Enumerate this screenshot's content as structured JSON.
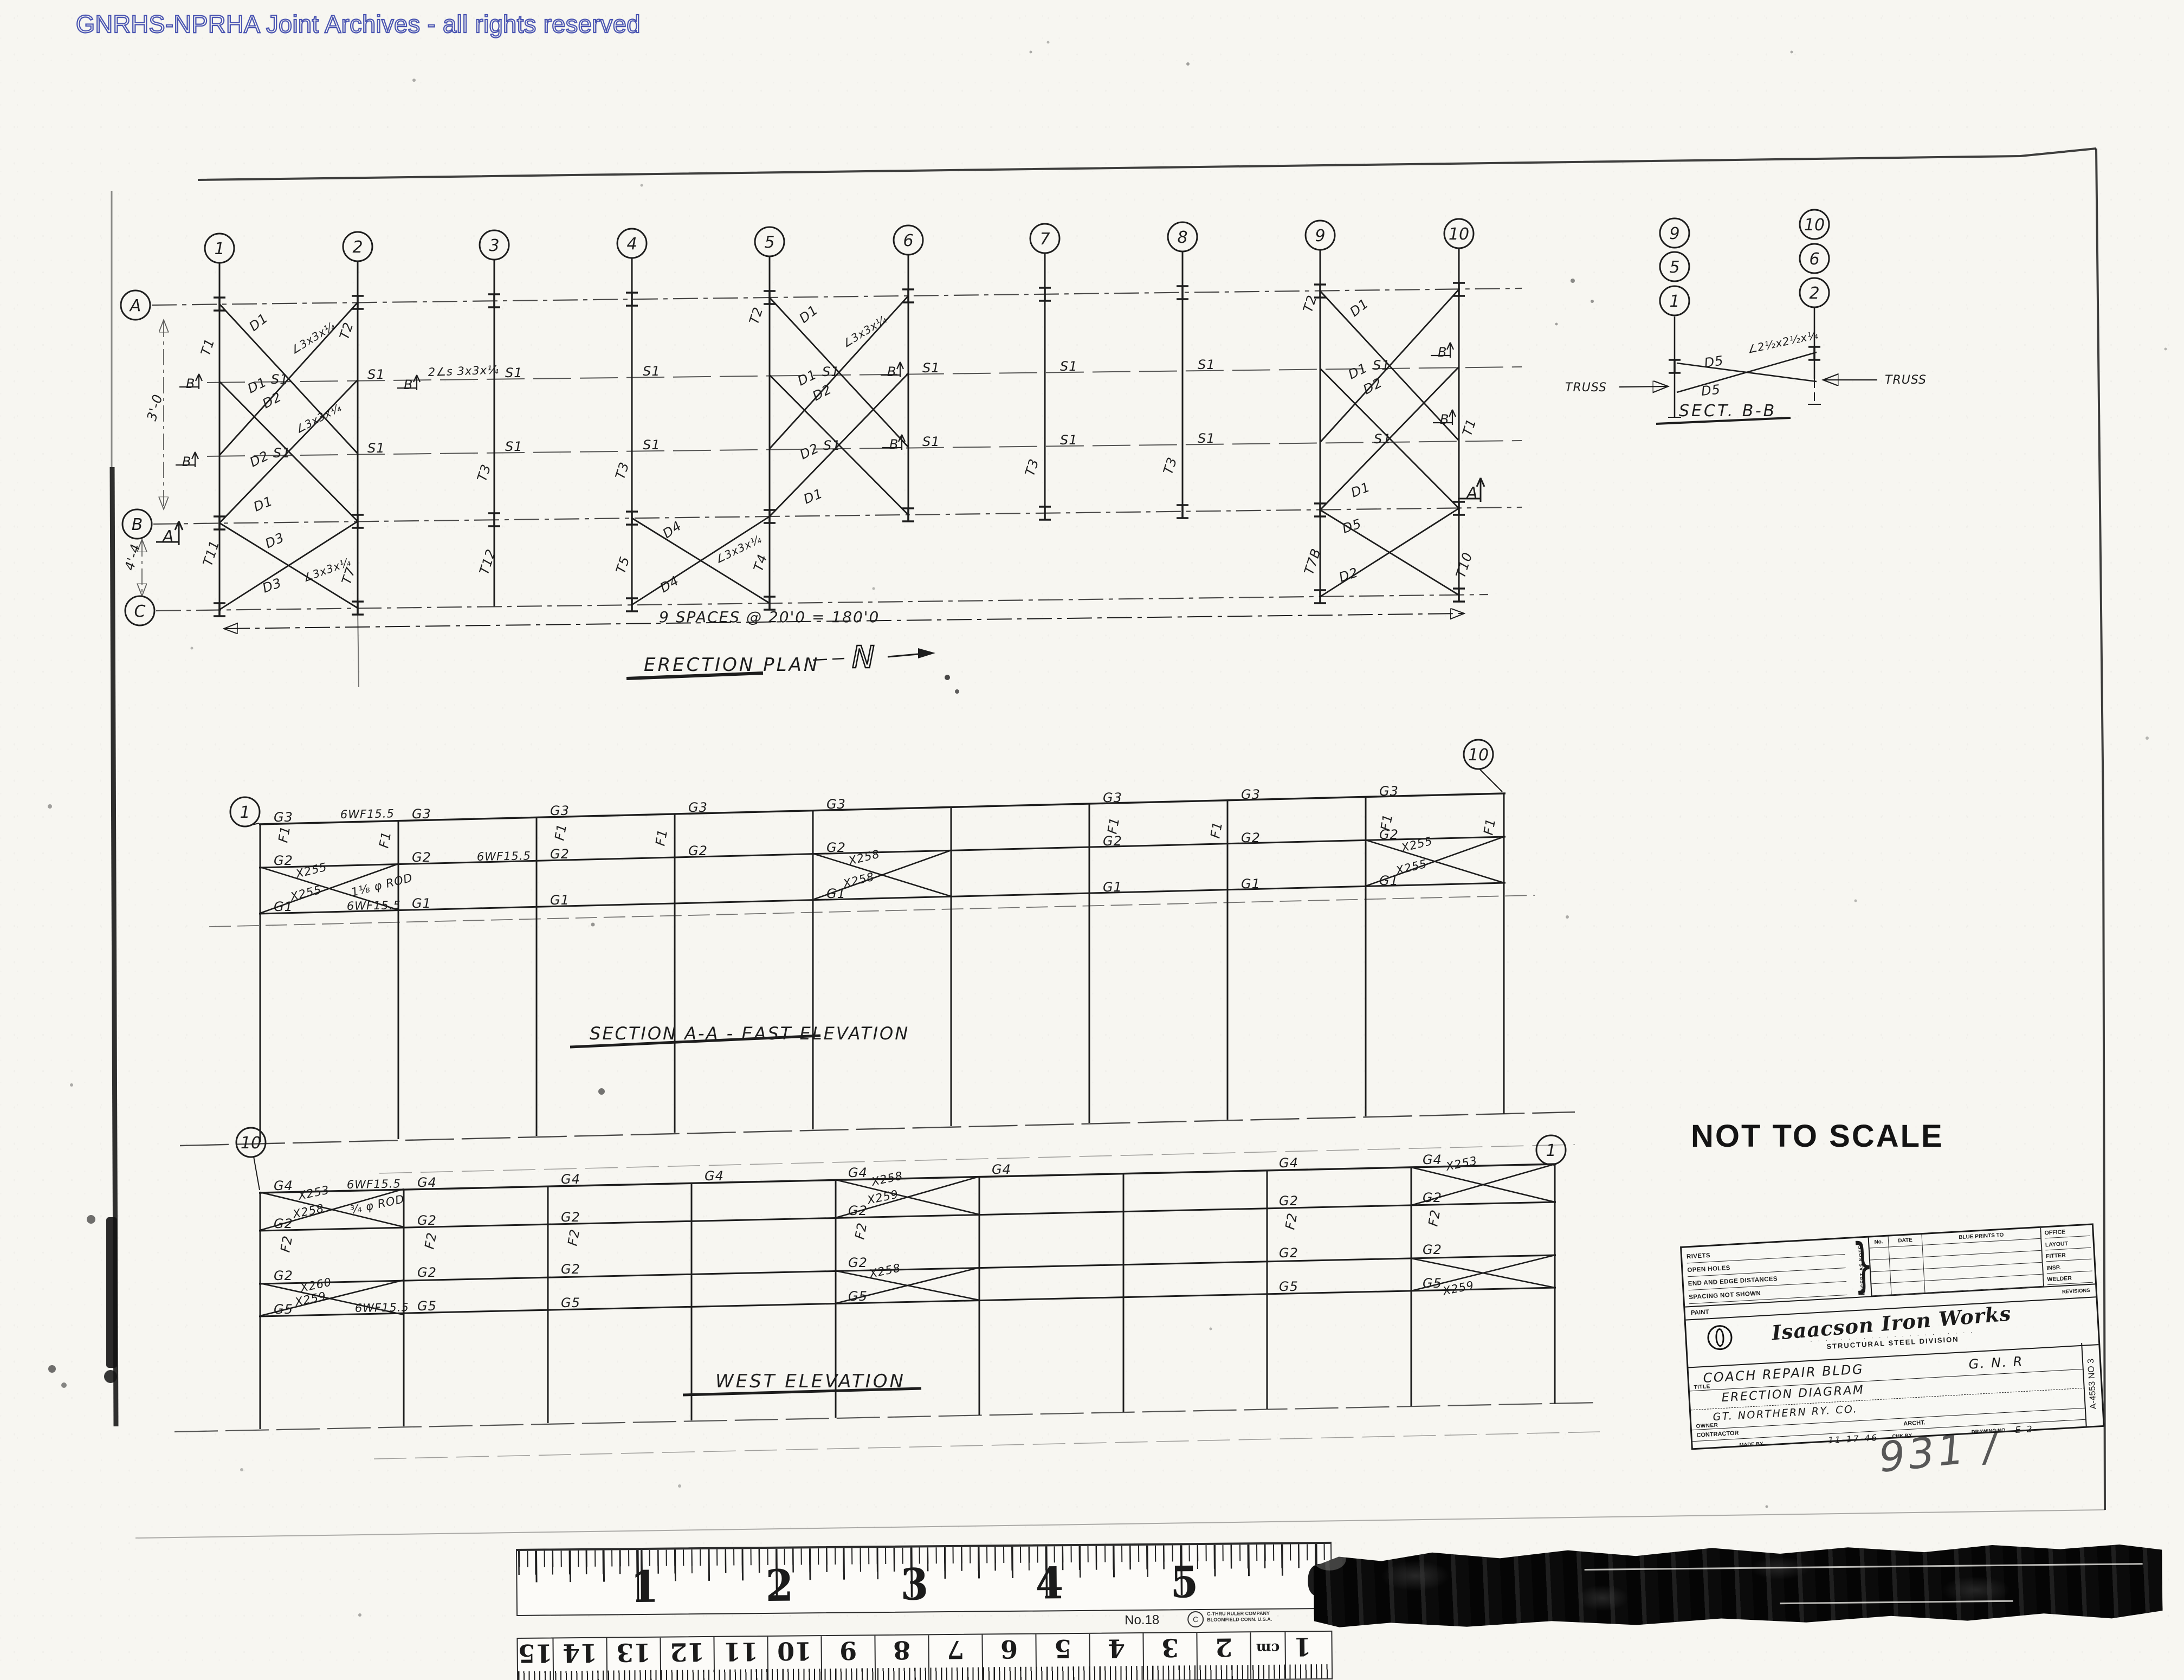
{
  "watermark": "GNRHS-NPRHA Joint Archives - all rights reserved",
  "titles": {
    "erection_plan": "ERECTION PLAN",
    "north": "N",
    "spaces_note": "9 SPACES @ 20'0 = 180'0",
    "section_aa": "SECTION A-A  -  EAST ELEVATION",
    "west_elevation": "WEST  ELEVATION",
    "sect_bb": "SECT. B-B",
    "not_to_scale": "NOT TO SCALE",
    "handwritten_note": "931 /"
  },
  "bubbles": [
    [
      "1",
      405,
      458
    ],
    [
      "2",
      660,
      455
    ],
    [
      "3",
      912,
      452
    ],
    [
      "4",
      1166,
      449
    ],
    [
      "5",
      1420,
      446
    ],
    [
      "6",
      1676,
      443
    ],
    [
      "7",
      1928,
      440
    ],
    [
      "8",
      2182,
      437
    ],
    [
      "9",
      2436,
      434
    ],
    [
      "10",
      2692,
      431
    ],
    [
      "A",
      250,
      563
    ],
    [
      "B",
      253,
      967
    ],
    [
      "C",
      258,
      1127
    ],
    [
      "1",
      452,
      1498
    ],
    [
      "10",
      2728,
      1392
    ],
    [
      "10",
      463,
      2108
    ],
    [
      "1",
      2862,
      2122
    ],
    [
      "9",
      3090,
      430
    ],
    [
      "5",
      3090,
      492
    ],
    [
      "1",
      3090,
      555
    ],
    [
      "10",
      3348,
      414
    ],
    [
      "6",
      3348,
      477
    ],
    [
      "2",
      3348,
      540
    ]
  ],
  "plan": {
    "ibeams": [
      [
        405,
        561
      ],
      [
        660,
        558
      ],
      [
        912,
        555
      ],
      [
        1166,
        552
      ],
      [
        1420,
        549
      ],
      [
        1676,
        546
      ],
      [
        1928,
        543
      ],
      [
        2182,
        540
      ],
      [
        2436,
        537
      ],
      [
        2692,
        534
      ],
      [
        405,
        965
      ],
      [
        660,
        962
      ],
      [
        912,
        959
      ],
      [
        1166,
        956
      ],
      [
        1420,
        953
      ],
      [
        1676,
        950
      ],
      [
        1928,
        947
      ],
      [
        2182,
        944
      ],
      [
        2436,
        941
      ],
      [
        2692,
        938
      ],
      [
        405,
        1125
      ],
      [
        660,
        1122
      ],
      [
        1166,
        1116
      ],
      [
        1420,
        1113
      ],
      [
        2436,
        1101
      ],
      [
        2692,
        1098
      ],
      [
        3090,
        676
      ],
      [
        3348,
        652
      ]
    ]
  },
  "labels": [
    [
      "T1",
      386,
      658,
      -72
    ],
    [
      "T2",
      642,
      628,
      -72
    ],
    [
      "T3",
      896,
      890,
      -72
    ],
    [
      "T3",
      1151,
      886,
      -72
    ],
    [
      "T2",
      1398,
      600,
      -72
    ],
    [
      "T3",
      1907,
      880,
      -72
    ],
    [
      "T3",
      2162,
      877,
      -72
    ],
    [
      "T2",
      2420,
      578,
      -72
    ],
    [
      "T1",
      2714,
      806,
      -72
    ],
    [
      "T11",
      390,
      1046,
      -72
    ],
    [
      "T7",
      646,
      1080,
      -72
    ],
    [
      "T12",
      900,
      1062,
      -72
    ],
    [
      "T5",
      1152,
      1060,
      -72
    ],
    [
      "T4",
      1406,
      1056,
      -72
    ],
    [
      "T7B",
      2422,
      1062,
      -72
    ],
    [
      "T10",
      2702,
      1068,
      -72
    ],
    [
      "D1",
      468,
      612,
      -38
    ],
    [
      "∠3x3x¼",
      542,
      654,
      -32,
      20
    ],
    [
      "D1",
      462,
      726,
      -26
    ],
    [
      "S1",
      500,
      708,
      0
    ],
    [
      "D2",
      490,
      754,
      -28
    ],
    [
      "∠3x3x¼",
      550,
      800,
      -28,
      20
    ],
    [
      "D2",
      466,
      862,
      -26
    ],
    [
      "S1",
      504,
      844,
      0
    ],
    [
      "D1",
      472,
      944,
      -22
    ],
    [
      "D1",
      1483,
      597,
      -38
    ],
    [
      "D1",
      1477,
      712,
      -26
    ],
    [
      "S1",
      1517,
      694,
      0
    ],
    [
      "D2",
      1505,
      740,
      -28
    ],
    [
      "D2",
      1481,
      848,
      -26
    ],
    [
      "S1",
      1519,
      830,
      0
    ],
    [
      "D1",
      1487,
      930,
      -22
    ],
    [
      "∠3x3x¼",
      1560,
      642,
      -32,
      20
    ],
    [
      "D1",
      2499,
      585,
      -38
    ],
    [
      "D1",
      2493,
      700,
      -26
    ],
    [
      "S1",
      2533,
      682,
      0
    ],
    [
      "D2",
      2521,
      728,
      -28
    ],
    [
      "S1",
      2535,
      818,
      0
    ],
    [
      "D1",
      2497,
      918,
      -22
    ],
    [
      "D3",
      494,
      1012,
      -24
    ],
    [
      "D3",
      488,
      1094,
      -20
    ],
    [
      "∠3x3x¼",
      562,
      1074,
      -20,
      20
    ],
    [
      "D4",
      1230,
      994,
      -34
    ],
    [
      "D4",
      1224,
      1094,
      -30
    ],
    [
      "∠3x3x¼",
      1324,
      1040,
      -26,
      20
    ],
    [
      "D5",
      2480,
      984,
      -18
    ],
    [
      "D2",
      2474,
      1074,
      -18
    ],
    [
      "S1",
      678,
      699
    ],
    [
      "S1",
      932,
      696
    ],
    [
      "S1",
      1186,
      693
    ],
    [
      "S1",
      1702,
      687
    ],
    [
      "S1",
      1956,
      684
    ],
    [
      "S1",
      2210,
      681
    ],
    [
      "S1",
      678,
      835
    ],
    [
      "S1",
      932,
      832
    ],
    [
      "S1",
      1186,
      829
    ],
    [
      "S1",
      1702,
      823
    ],
    [
      "S1",
      1956,
      820
    ],
    [
      "S1",
      2210,
      817
    ],
    [
      "2∠s 3x3x¼",
      790,
      694,
      -2,
      21
    ],
    [
      "B",
      343,
      716
    ],
    [
      "B",
      336,
      860
    ],
    [
      "B",
      745,
      718
    ],
    [
      "B",
      1637,
      694
    ],
    [
      "B",
      1641,
      828
    ],
    [
      "B",
      2653,
      658
    ],
    [
      "B",
      2657,
      782
    ],
    [
      "A",
      300,
      1000,
      0,
      30
    ],
    [
      "A",
      2706,
      920,
      0,
      30
    ],
    [
      "3'-0",
      287,
      778,
      -75
    ],
    [
      "4'-4",
      246,
      1054,
      -75
    ],
    [
      "G3",
      505,
      1516
    ],
    [
      "G3",
      760,
      1510
    ],
    [
      "G3",
      1015,
      1504
    ],
    [
      "G3",
      1270,
      1498
    ],
    [
      "G3",
      1525,
      1492
    ],
    [
      "G3",
      2035,
      1480
    ],
    [
      "G3",
      2290,
      1474
    ],
    [
      "G3",
      2545,
      1468
    ],
    [
      "G2",
      505,
      1596
    ],
    [
      "G2",
      760,
      1590
    ],
    [
      "G2",
      1015,
      1584
    ],
    [
      "G2",
      1270,
      1578
    ],
    [
      "G2",
      1525,
      1572
    ],
    [
      "G2",
      2035,
      1560
    ],
    [
      "G2",
      2290,
      1554
    ],
    [
      "G2",
      2545,
      1548
    ],
    [
      "G1",
      505,
      1681
    ],
    [
      "G1",
      760,
      1675
    ],
    [
      "G1",
      1015,
      1669
    ],
    [
      "G1",
      1525,
      1657
    ],
    [
      "G1",
      2035,
      1645
    ],
    [
      "G1",
      2290,
      1639
    ],
    [
      "G1",
      2545,
      1633
    ],
    [
      "6WF15.5",
      628,
      1510,
      -1,
      21
    ],
    [
      "6WF15.5",
      880,
      1588,
      -1,
      21
    ],
    [
      "6WF15.5",
      640,
      1679,
      -1,
      21
    ],
    [
      "F1",
      530,
      1556,
      -80
    ],
    [
      "F1",
      716,
      1566,
      -80
    ],
    [
      "F1",
      1040,
      1552,
      -80
    ],
    [
      "F1",
      1226,
      1562,
      -80
    ],
    [
      "F1",
      2060,
      1540,
      -80
    ],
    [
      "F1",
      2250,
      1548,
      -80
    ],
    [
      "F1",
      2564,
      1534,
      -80
    ],
    [
      "F1",
      2754,
      1542,
      -80
    ],
    [
      "X255",
      548,
      1620,
      -14,
      21
    ],
    [
      "X255",
      538,
      1662,
      -14,
      21
    ],
    [
      "1⅛ φ ROD",
      650,
      1654,
      -14,
      21
    ],
    [
      "X258",
      1568,
      1596,
      -14,
      21
    ],
    [
      "X258",
      1558,
      1638,
      -14,
      21
    ],
    [
      "X255",
      2588,
      1572,
      -14,
      21
    ],
    [
      "X255",
      2578,
      1614,
      -14,
      21
    ],
    [
      "G4",
      505,
      2196
    ],
    [
      "G4",
      770,
      2190
    ],
    [
      "G4",
      1035,
      2184
    ],
    [
      "G4",
      1300,
      2178
    ],
    [
      "G4",
      1565,
      2172
    ],
    [
      "G4",
      1830,
      2166
    ],
    [
      "G4",
      2360,
      2154
    ],
    [
      "G4",
      2625,
      2148
    ],
    [
      "G2",
      505,
      2266
    ],
    [
      "G2",
      770,
      2260
    ],
    [
      "G2",
      1035,
      2254
    ],
    [
      "G2",
      1565,
      2242
    ],
    [
      "G2",
      2360,
      2224
    ],
    [
      "G2",
      2625,
      2218
    ],
    [
      "G2",
      505,
      2362
    ],
    [
      "G2",
      770,
      2356
    ],
    [
      "G2",
      1035,
      2350
    ],
    [
      "G2",
      1565,
      2338
    ],
    [
      "G2",
      2360,
      2320
    ],
    [
      "G2",
      2625,
      2314
    ],
    [
      "G5",
      505,
      2424
    ],
    [
      "G5",
      770,
      2418
    ],
    [
      "G5",
      1035,
      2412
    ],
    [
      "G5",
      1565,
      2400
    ],
    [
      "G5",
      2360,
      2382
    ],
    [
      "G5",
      2625,
      2376
    ],
    [
      "6WF15.5",
      640,
      2193,
      -1,
      21
    ],
    [
      "6WF15.5",
      655,
      2421,
      -1,
      21
    ],
    [
      "F2",
      534,
      2312,
      -80
    ],
    [
      "F2",
      800,
      2306,
      -80
    ],
    [
      "F2",
      1064,
      2300,
      -80
    ],
    [
      "F2",
      1594,
      2288,
      -80
    ],
    [
      "F2",
      2388,
      2270,
      -80
    ],
    [
      "F2",
      2652,
      2264,
      -80
    ],
    [
      "X253",
      552,
      2214,
      -12,
      21
    ],
    [
      "X258",
      542,
      2248,
      -12,
      21
    ],
    [
      "¾ φ ROD",
      648,
      2240,
      -12,
      21
    ],
    [
      "X260",
      556,
      2384,
      -12,
      21
    ],
    [
      "X259",
      546,
      2410,
      -12,
      21
    ],
    [
      "X258",
      1610,
      2188,
      -12,
      21
    ],
    [
      "X259",
      1602,
      2222,
      -12,
      21
    ],
    [
      "X258",
      1606,
      2358,
      -12,
      21
    ],
    [
      "X253",
      2670,
      2160,
      -12,
      21
    ],
    [
      "X259",
      2664,
      2390,
      -12,
      21
    ],
    [
      "D5",
      3146,
      678,
      -8
    ],
    [
      "D5",
      3140,
      730,
      -6
    ],
    [
      "∠2½x2½x¼",
      3226,
      652,
      -12,
      20
    ],
    [
      "TRUSS",
      2888,
      722,
      0,
      22
    ],
    [
      "TRUSS",
      3478,
      708,
      0,
      22
    ]
  ],
  "title_block": {
    "rivets": "RIVETS",
    "open_holes": "OPEN HOLES",
    "end_edge": "END AND EDGE DISTANCES",
    "spacing": "SPACING NOT SHOWN",
    "paint": "PAINT",
    "except": "EXCEPT AS NOTED",
    "no": "No.",
    "date": "DATE",
    "blueprints": "BLUE PRINTS TO",
    "office": "OFFICE",
    "layout": "LAYOUT",
    "fitter": "FITTER",
    "insp": "INSP.",
    "welder": "WELDER",
    "revisions": "REVISIONS",
    "company": "Isaacson Iron Works",
    "tagline_dots": "· · · · · · · · · · · · · · · · · · · · · ·",
    "division": "STRUCTURAL STEEL DIVISION",
    "project": "COACH REPAIR BLDG",
    "railroad": "G. N. R",
    "label_title": "TITLE",
    "subtitle": "ERECTION DIAGRAM",
    "owner_value": "GT. NORTHERN RY. CO.",
    "label_owner": "OWNER",
    "label_contractor": "CONTRACTOR",
    "label_archt": "ARCHT.",
    "label_made": "MADE BY",
    "label_chk": "CHK BY",
    "label_drawing_no": "DRAWING NO",
    "made_date": "11-17-46",
    "drawing_no": "E-2",
    "job_no": "A-4553  NO 3"
  },
  "ruler": {
    "inches": [
      "1",
      "2",
      "3",
      "4",
      "5",
      "6"
    ],
    "no": "No.18",
    "brand1": "C-THRU RULER COMPANY",
    "brand2": "BLOOMFIELD CONN. U.S.A.",
    "cm_cells": [
      "15",
      "14",
      "13",
      "12",
      "11",
      "10",
      "9",
      "8",
      "7",
      "6",
      "5",
      "4",
      "3",
      "2",
      "cm",
      "1"
    ]
  }
}
